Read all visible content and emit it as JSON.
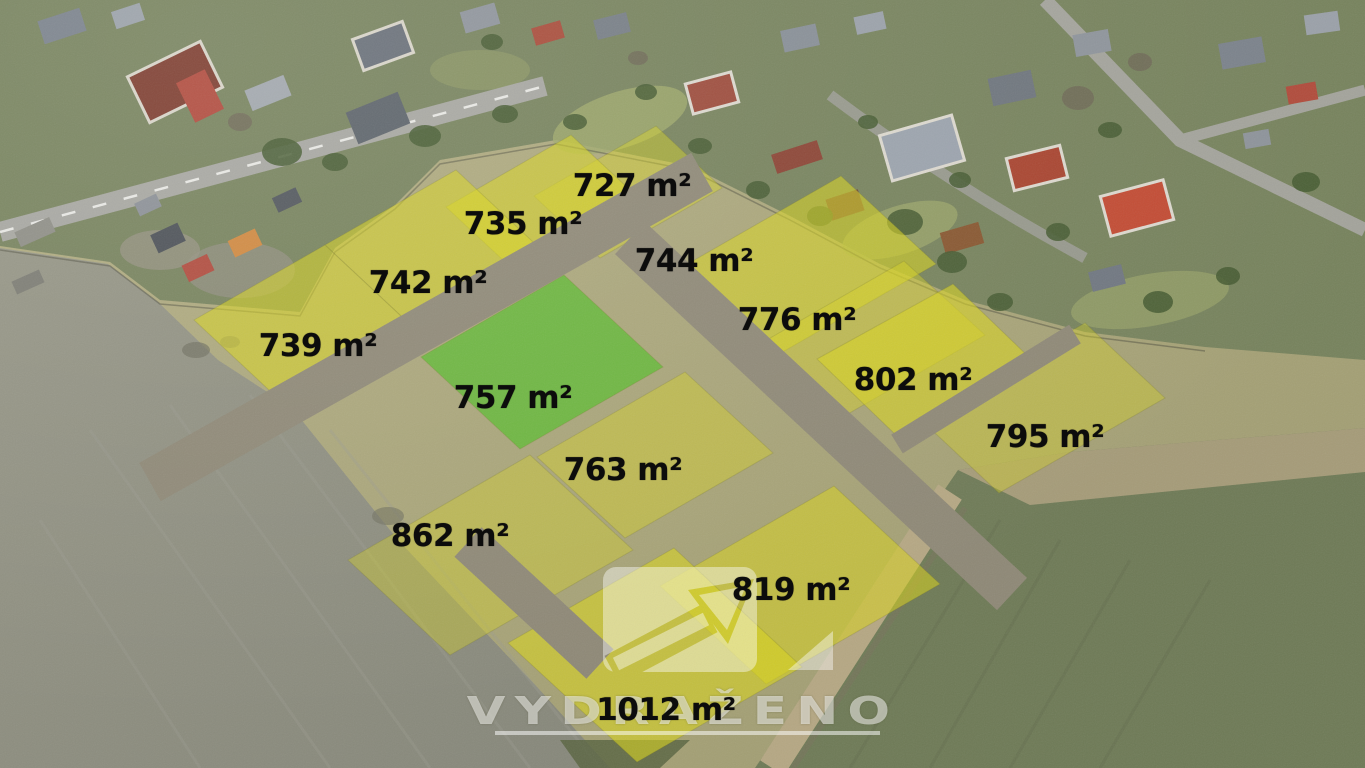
{
  "plots": [
    {
      "label": "727 m²",
      "area_m2": 727,
      "highlight": "yellow"
    },
    {
      "label": "735 m²",
      "area_m2": 735,
      "highlight": "yellow"
    },
    {
      "label": "742 m²",
      "area_m2": 742,
      "highlight": "yellow"
    },
    {
      "label": "744 m²",
      "area_m2": 744,
      "highlight": "yellow"
    },
    {
      "label": "739 m²",
      "area_m2": 739,
      "highlight": "yellow"
    },
    {
      "label": "776 m²",
      "area_m2": 776,
      "highlight": "yellow"
    },
    {
      "label": "802 m²",
      "area_m2": 802,
      "highlight": "yellow"
    },
    {
      "label": "757 m²",
      "area_m2": 757,
      "highlight": "green"
    },
    {
      "label": "795 m²",
      "area_m2": 795,
      "highlight": "yellow"
    },
    {
      "label": "763 m²",
      "area_m2": 763,
      "highlight": "yellow"
    },
    {
      "label": "862 m²",
      "area_m2": 862,
      "highlight": "yellow"
    },
    {
      "label": "819 m²",
      "area_m2": 819,
      "highlight": "yellow"
    },
    {
      "label": "1012 m²",
      "area_m2": 1012,
      "highlight": "yellow"
    }
  ],
  "watermark": {
    "text": "VYDRAŽENO",
    "logo_icon": "arrow-up-right-auction-logo",
    "color": "#ffffff"
  },
  "colors": {
    "plot_yellow": "#d8d41c",
    "plot_green": "#55bb28",
    "label_text": "#0c0c0c",
    "road_gray": "#8e8876",
    "field_gray": "#8f9080",
    "field_green": "#6e7a56",
    "grass_olive": "#a8a478",
    "roof_red": "#a84632",
    "roof_gray": "#8a9099"
  }
}
